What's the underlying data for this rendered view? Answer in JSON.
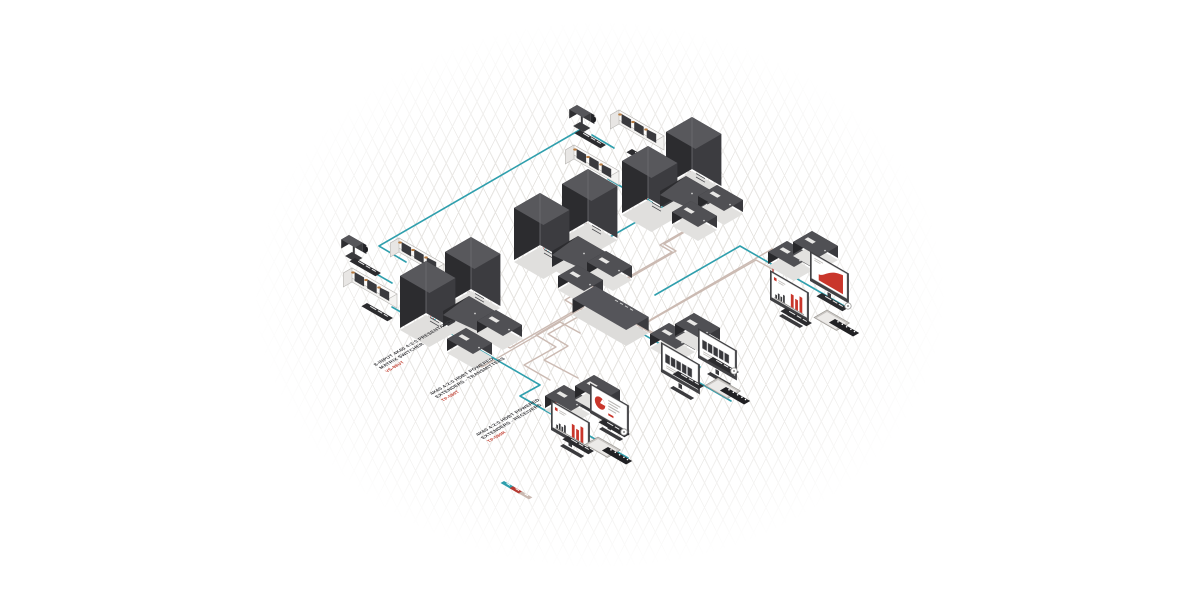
{
  "colors": {
    "network_line": "#2f9fad",
    "video_line": "#b63b32",
    "hdbt_line": "#cbbab2",
    "device_dark": "#3b3b3e",
    "device_top": "#57575b",
    "accent_red": "#c9362b"
  },
  "annotations": [
    {
      "line1": "8-INPUT 4K60 4:2:0 PRESENTATION",
      "line2": "MATRIX SWITCHER",
      "model": "VS-88UT"
    },
    {
      "line1": "4K60 4:2:0 HDBT POWERED",
      "line2": "EXTENDERS - TRANSMITTERS",
      "model": "TP-580T"
    },
    {
      "line1": "4K60 4:2:0 HDBT POWERED",
      "line2": "EXTENDERS - RECEIVERS",
      "model": "TP-580R"
    }
  ],
  "legend": {
    "colors": [
      "#2f9fad",
      "#b63b32",
      "#c9b9b1"
    ]
  }
}
